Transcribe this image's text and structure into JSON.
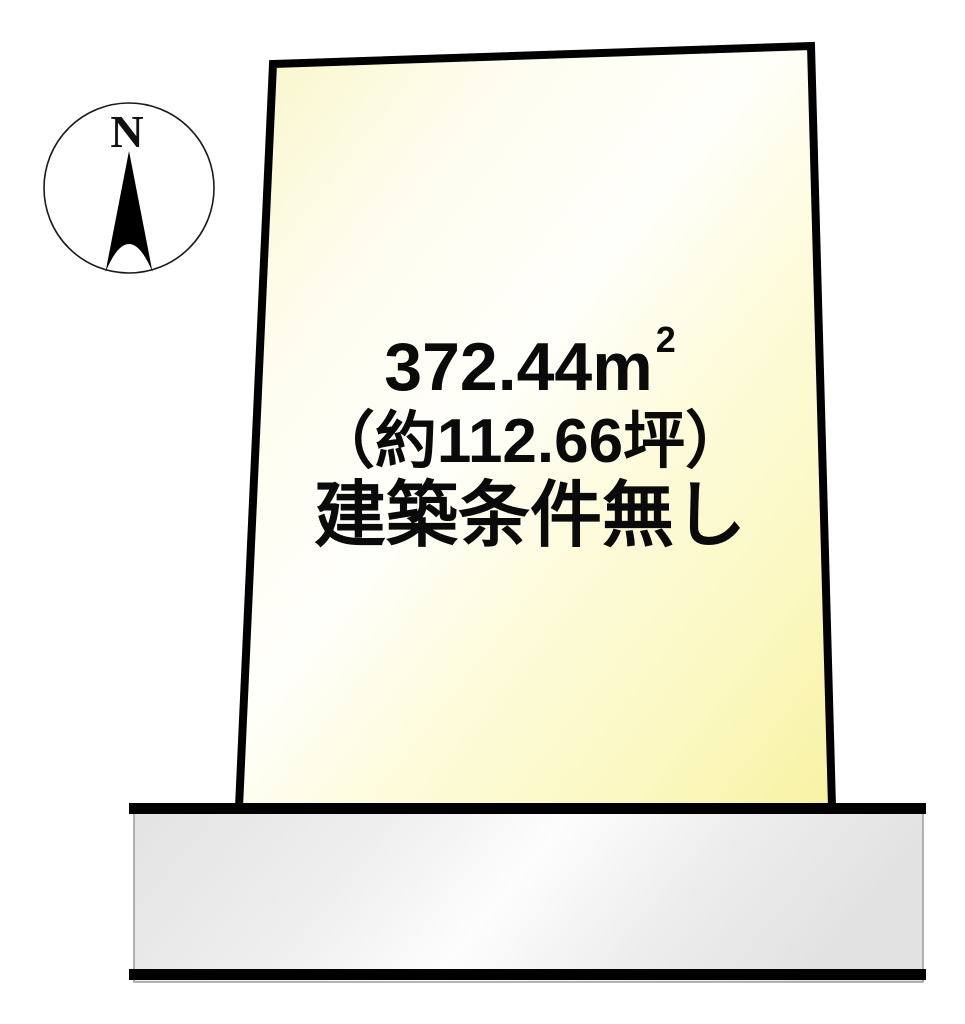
{
  "compass": {
    "north_label": "N"
  },
  "parcel": {
    "area_text": {
      "number": "372.44",
      "unit": "m",
      "unit_exponent": "2"
    },
    "tsubo_text": "（約112.66坪）",
    "condition_text": "建築条件無し",
    "border_color": "#000000",
    "fill_color_light": "#fffef8",
    "fill_color_yellow": "#f8f2a2"
  },
  "road": {
    "edge_color": "#000000",
    "fill_color_light": "#fdfdfd",
    "fill_color_gray": "#e3e3e3",
    "outline_color": "#9c9c9c"
  }
}
